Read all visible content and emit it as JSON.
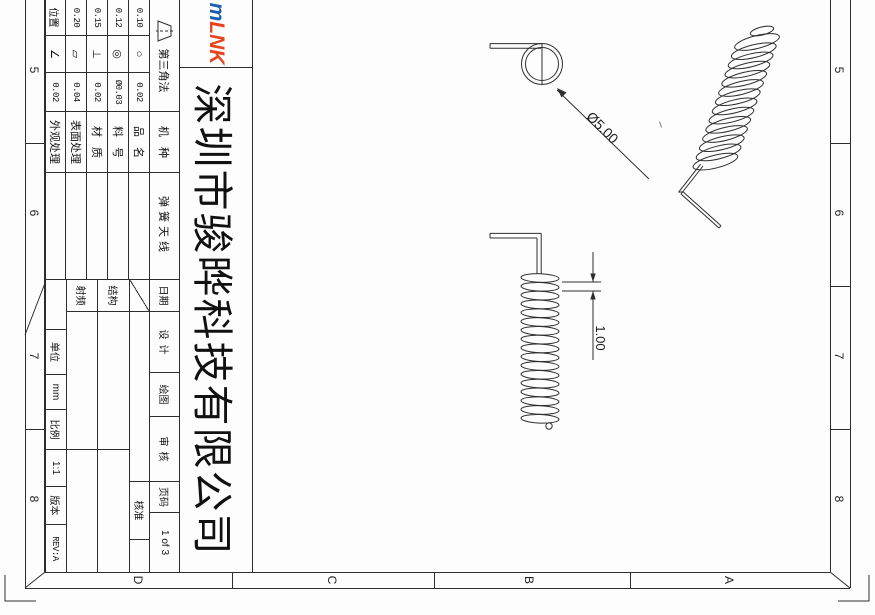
{
  "company": {
    "name": "深圳市骏晔科技有限公司"
  },
  "logo": {
    "part1": "m",
    "part2": "LNK",
    "part1_color": "#1a5fae",
    "part2_color": "#e8431f"
  },
  "projection": {
    "label": "第三角法"
  },
  "tolerance": {
    "rows": [
      {
        "size": "0.10",
        "symbol": "○",
        "value": "0.02"
      },
      {
        "size": "0.12",
        "symbol": "◎",
        "value": "Ø0.03"
      },
      {
        "size": "0.15",
        "symbol": "⊥",
        "value": "0.02"
      },
      {
        "size": "0.20",
        "symbol": "▱",
        "value": "0.04"
      },
      {
        "size": "位置",
        "symbol": "∠",
        "value": "0.02"
      }
    ]
  },
  "fields": {
    "machine_label": "机种",
    "machine_value": "弹簧天线",
    "product_label": "品名",
    "product_value": "",
    "part_no_label": "料号",
    "part_no_value": "",
    "material_label": "材质",
    "material_value": "",
    "surface_label": "表面处理",
    "surface_value": "",
    "appearance_label": "外观处理",
    "appearance_value": ""
  },
  "signoff": {
    "date_label": "日期",
    "design_label": "设计",
    "draft_label": "绘图",
    "review_label": "审核",
    "page_label": "页码",
    "page_value": "1 of 3",
    "approve_label": "核准",
    "structure_label": "结构",
    "rf_label": "射频"
  },
  "footer": {
    "unit_label": "单位",
    "unit_value": "mm",
    "scale_label": "比例",
    "scale_value": "1:1",
    "rev_label": "版本",
    "rev_value": "REV:A"
  },
  "zones": {
    "rows": [
      "5",
      "6",
      "7",
      "8"
    ],
    "cols": [
      "D",
      "C",
      "B",
      "A"
    ]
  },
  "dimensions": {
    "coil_outer_diameter": "Ø5.00",
    "wire_diameter": "1.00"
  }
}
